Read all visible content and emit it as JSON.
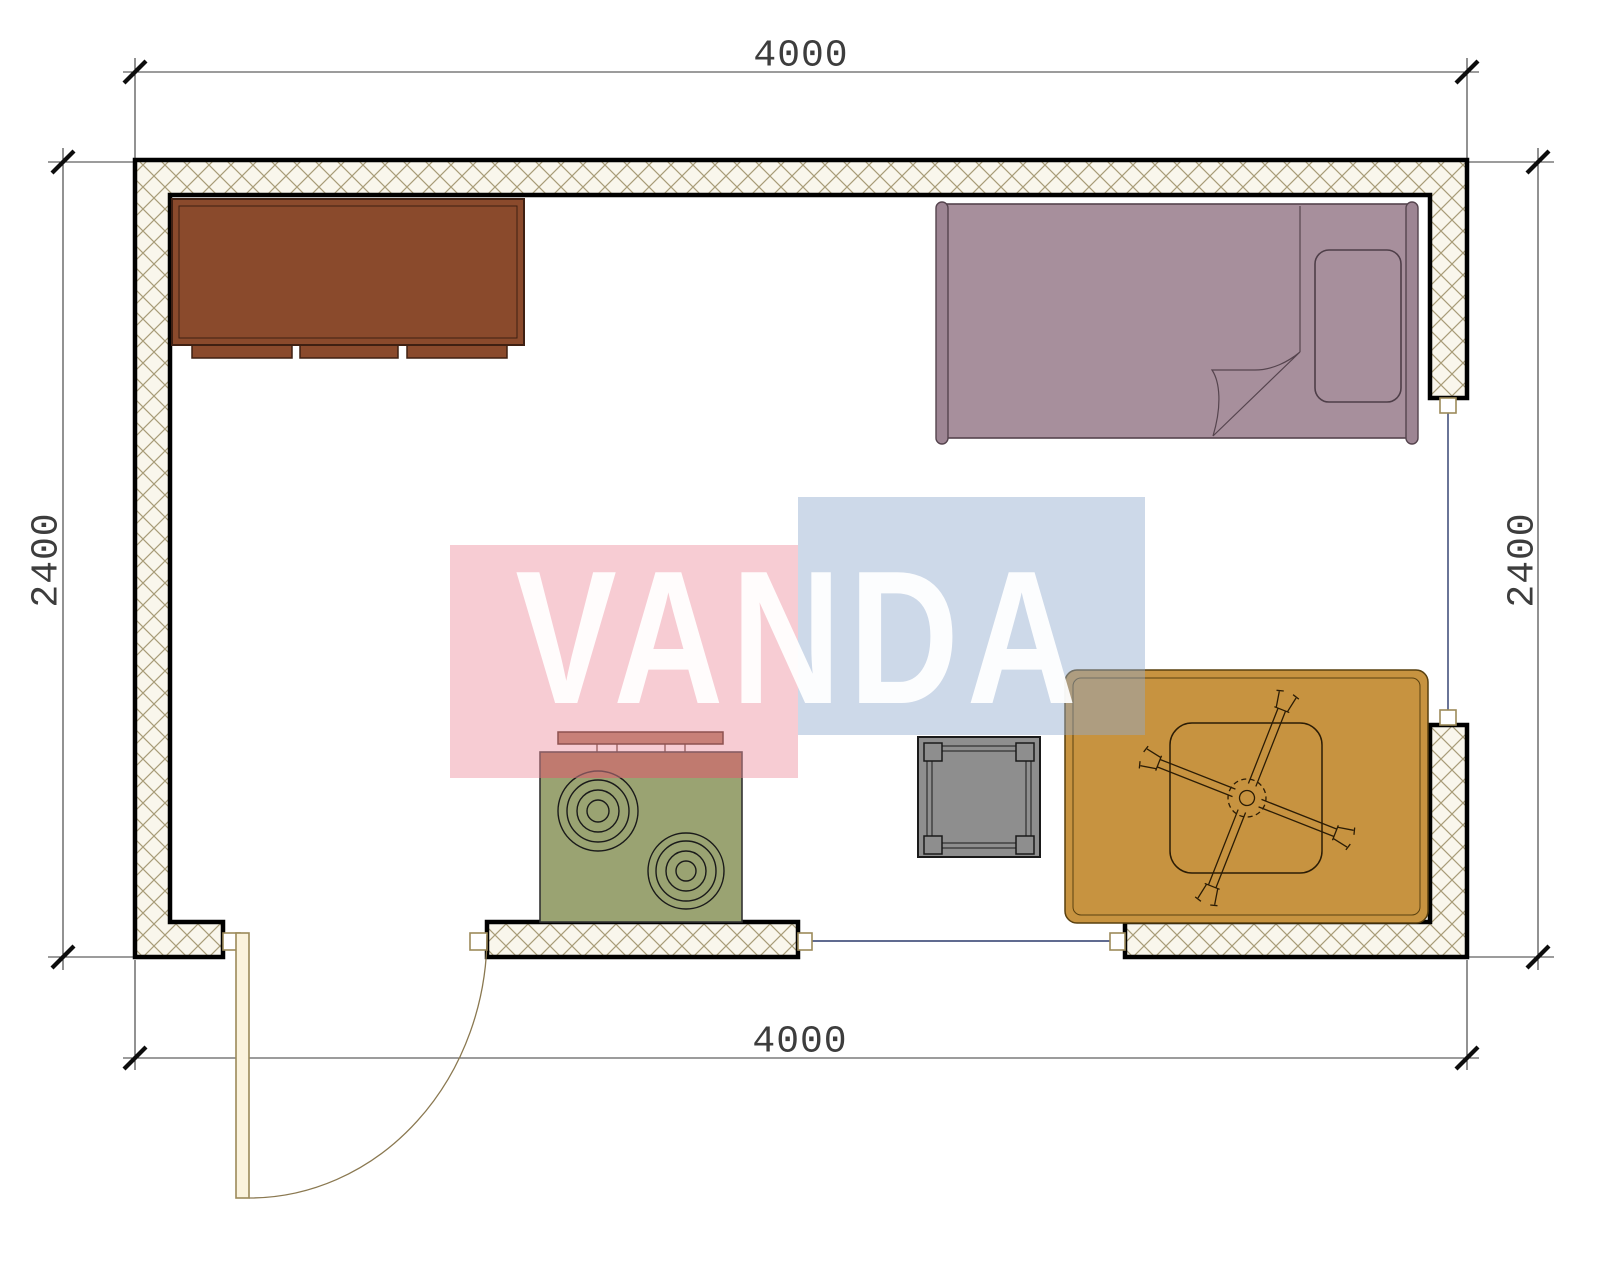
{
  "title": "Room floor plan with furniture",
  "watermark": {
    "text": "VANDA",
    "pink_color": "#f7ccd3",
    "blue_color": "#cdd9e9",
    "text_color": "#ffffff"
  },
  "dimensions": {
    "top": {
      "label": "4000"
    },
    "bottom": {
      "label": "4000"
    },
    "left": {
      "label": "2400"
    },
    "right": {
      "label": "2400"
    }
  },
  "plan": {
    "wall_fill": "#f9f6ec",
    "wall_hatch_line_color": "#a89c78",
    "wall_border_color": "#000000",
    "window_line_color": "#2b3a6b",
    "door_frame_color": "#9c8a5a",
    "furniture": [
      {
        "name": "dresser",
        "color": "#8a4a2c"
      },
      {
        "name": "bed",
        "color": "#a78f9c"
      },
      {
        "name": "stove",
        "color": "#9aa372",
        "top_strip_color": "#9b6b4a"
      },
      {
        "name": "coffee-table",
        "color": "#8e8e8e"
      },
      {
        "name": "rug-with-ceiling-fan",
        "color": "#c79340"
      },
      {
        "name": "door"
      },
      {
        "name": "window-right"
      },
      {
        "name": "window-bottom"
      }
    ]
  }
}
